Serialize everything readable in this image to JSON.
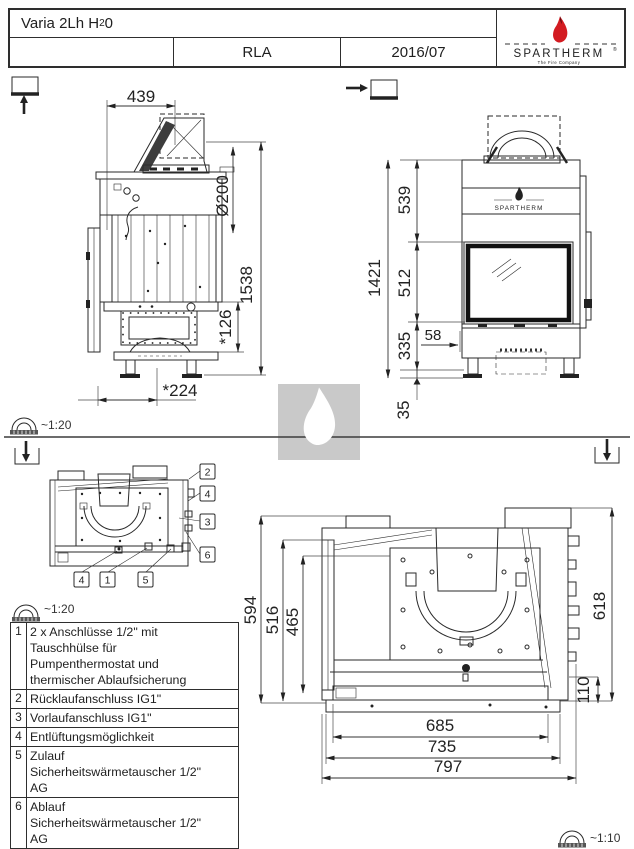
{
  "colors": {
    "line": "#2a2a2a",
    "flame_red": "#d31b21",
    "flame_tip": "#5c0c10",
    "watermark_bg": "#c9c9c9",
    "tagline_gray": "#999999"
  },
  "title_block": {
    "model_pre": "Varia 2Lh H",
    "model_sub": "2",
    "model_post": "0",
    "code": "RLA",
    "date": "2016/07"
  },
  "logo": {
    "brand": "SPARTHERM",
    "reg": "®",
    "tagline": "The Fire Company"
  },
  "scales": {
    "side_view": "~1:20",
    "top_view_small": "~1:20",
    "top_view_large": "~1:10"
  },
  "side_view": {
    "dim_top_width": "439",
    "dim_flue_diameter": "Ø200",
    "dim_total_height": "1538",
    "dim_base_height": "*126",
    "dim_base_depth": "*224"
  },
  "front_view": {
    "brand": "SPARTHERM",
    "dim_hood_height": "539",
    "dim_total_height": "1421",
    "dim_glass_height": "512",
    "dim_glass_offset": "58",
    "dim_base_height": "335",
    "dim_foot_height": "35"
  },
  "top_view_small": {
    "callouts_right": [
      "2",
      "4",
      "3",
      "6"
    ],
    "callouts_bottom": [
      "4",
      "1",
      "5"
    ]
  },
  "top_view_large": {
    "dim_depth_total": "594",
    "dim_depth_mid": "516",
    "dim_depth_inner": "465",
    "dim_height_right": "618",
    "dim_offset_right": "110",
    "dim_width_inner": "685",
    "dim_width_mid": "735",
    "dim_width_total": "797"
  },
  "legend": {
    "items": [
      {
        "num": "1",
        "text": "2 x Anschlüsse 1/2\" mit\nTauschhülse für\nPumpenthermostat und\nthermischer Ablaufsicherung"
      },
      {
        "num": "2",
        "text": "Rücklaufanschluss IG1\""
      },
      {
        "num": "3",
        "text": "Vorlaufanschluss IG1\""
      },
      {
        "num": "4",
        "text": "Entlüftungsmöglichkeit"
      },
      {
        "num": "5",
        "text": "Zulauf\nSicherheitswärmetauscher 1/2\"\nAG"
      },
      {
        "num": "6",
        "text": "Ablauf\nSicherheitswärmetauscher 1/2\"\nAG"
      }
    ]
  }
}
